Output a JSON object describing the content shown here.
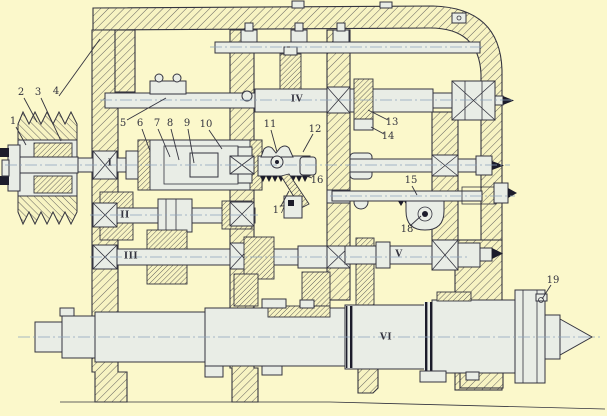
{
  "figure": {
    "kind": "engineering sectional drawing of a gearbox / lathe headstock",
    "colors": {
      "background": "#fbf8cb",
      "ink": "#34343f",
      "shaft_fill": "#e9ede6",
      "dark_fill": "#1c1c2b",
      "centerline": "#8ba3bd",
      "hatch_bg": "#f7f3c2"
    },
    "labels": {
      "parts": [
        "1",
        "2",
        "3",
        "4",
        "5",
        "6",
        "7",
        "8",
        "9",
        "10",
        "11",
        "12",
        "13",
        "14",
        "15",
        "16",
        "17",
        "18",
        "19"
      ],
      "shafts": [
        "I",
        "II",
        "III",
        "IV",
        "V",
        "VI"
      ]
    }
  }
}
